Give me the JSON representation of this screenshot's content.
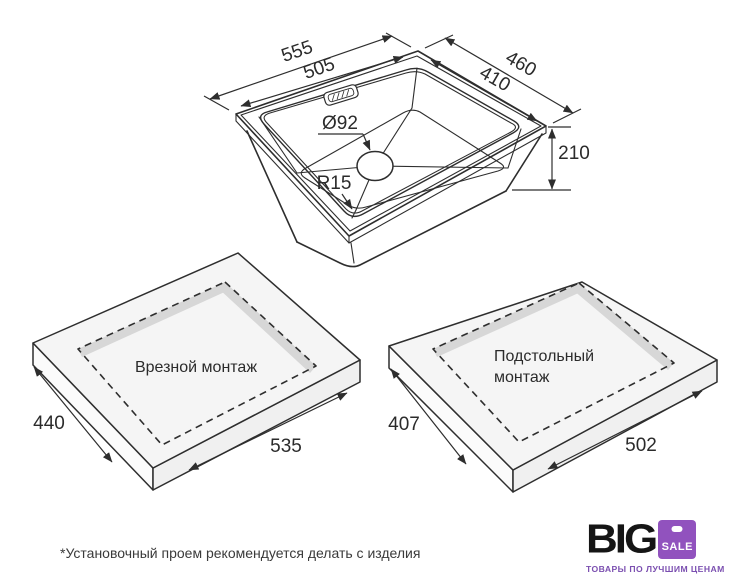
{
  "colors": {
    "line": "#2e2e2e",
    "slab_top": "#f5f5f5",
    "cutout_wall": "#d7d7d7",
    "logo_purple": "#9152be",
    "logo_black": "#151515",
    "tagline_purple": "#7b4fb0"
  },
  "sink": {
    "dims": {
      "outer_width": "555",
      "inner_width": "505",
      "outer_depth": "460",
      "inner_depth": "410",
      "height": "210",
      "drain_diameter": "Ø92",
      "corner_radius": "R15"
    }
  },
  "mounts": {
    "inset": {
      "label": "Врезной монтаж",
      "depth": "440",
      "width": "535"
    },
    "under": {
      "label": "Подстольный монтаж",
      "label_line1": "Подстольный",
      "label_line2": "монтаж",
      "depth": "407",
      "width": "502"
    }
  },
  "footnote": "*Установочный проем рекомендуется делать с изделия",
  "logo": {
    "brand": "BIG",
    "badge": "SALE",
    "tagline": "ТОВАРЫ ПО ЛУЧШИМ ЦЕНАМ"
  }
}
